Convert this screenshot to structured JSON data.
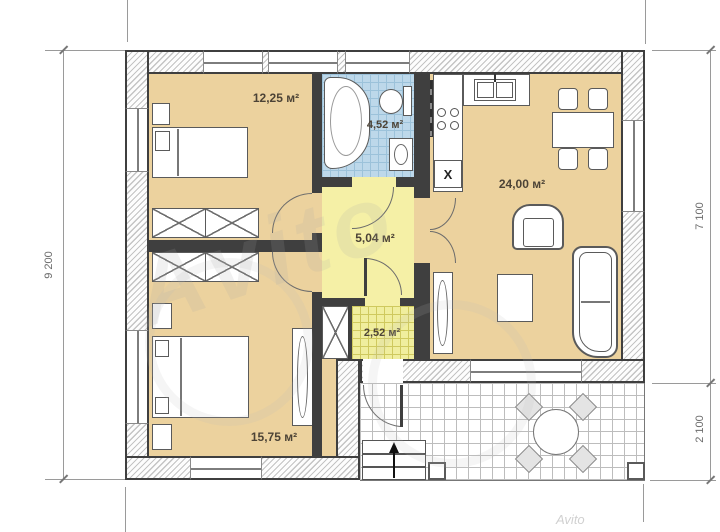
{
  "plan": {
    "title_hint": "single-storey house floor plan",
    "rooms": [
      {
        "key": "bedroom-top",
        "area": "12,25 м²"
      },
      {
        "key": "bathroom",
        "area": "4,52 м²"
      },
      {
        "key": "hallway",
        "area": "5,04 м²"
      },
      {
        "key": "tambour",
        "area": "2,52 м²"
      },
      {
        "key": "bedroom-bottom",
        "area": "15,75 м²"
      },
      {
        "key": "kitchen-living",
        "area": "24,00 м²"
      }
    ],
    "dimensions": {
      "left": "9 200",
      "right_upper": "7 100",
      "right_lower": "2 100"
    },
    "boiler_mark": "X",
    "watermark": "Avito",
    "watermark_small": "Avito"
  },
  "colors": {
    "wall_outline": "#3f3f3f",
    "floor_tan": "#ecd29e",
    "floor_yellow": "#f5f0a6",
    "floor_bath_tile": "#bdd8ea",
    "floor_tambour_tile": "#f0ee9e",
    "label_text": "#4c4336",
    "dimension_text": "#6b6b6b"
  }
}
